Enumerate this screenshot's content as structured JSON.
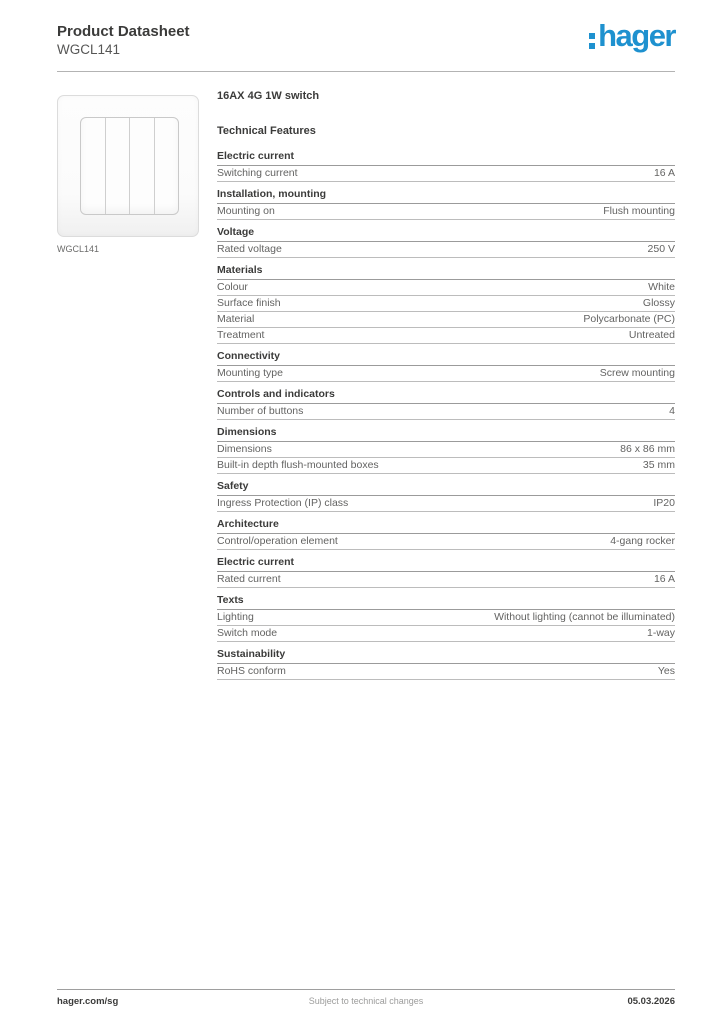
{
  "brand": {
    "logo_text": "hager",
    "brand_color": "#1e91cf"
  },
  "header": {
    "title": "Product Datasheet",
    "subtitle": "WGCL141"
  },
  "product": {
    "name": "16AX 4G 1W switch",
    "image_caption": "WGCL141",
    "rocker_gangs": 4
  },
  "technical_features_heading": "Technical Features",
  "sections": [
    {
      "heading": "Electric current",
      "rows": [
        {
          "label": "Switching current",
          "value": "16 A"
        }
      ]
    },
    {
      "heading": "Installation, mounting",
      "rows": [
        {
          "label": "Mounting on",
          "value": "Flush mounting"
        }
      ]
    },
    {
      "heading": "Voltage",
      "rows": [
        {
          "label": "Rated voltage",
          "value": "250 V"
        }
      ]
    },
    {
      "heading": "Materials",
      "rows": [
        {
          "label": "Colour",
          "value": "White"
        },
        {
          "label": "Surface finish",
          "value": "Glossy"
        },
        {
          "label": "Material",
          "value": "Polycarbonate (PC)"
        },
        {
          "label": "Treatment",
          "value": "Untreated"
        }
      ]
    },
    {
      "heading": "Connectivity",
      "rows": [
        {
          "label": "Mounting type",
          "value": "Screw mounting"
        }
      ]
    },
    {
      "heading": "Controls and indicators",
      "rows": [
        {
          "label": "Number of buttons",
          "value": "4"
        }
      ]
    },
    {
      "heading": "Dimensions",
      "rows": [
        {
          "label": "Dimensions",
          "value": "86 x 86 mm"
        },
        {
          "label": "Built-in depth flush-mounted boxes",
          "value": "35 mm"
        }
      ]
    },
    {
      "heading": "Safety",
      "rows": [
        {
          "label": "Ingress Protection (IP) class",
          "value": "IP20"
        }
      ]
    },
    {
      "heading": "Architecture",
      "rows": [
        {
          "label": "Control/operation element",
          "value": "4-gang rocker"
        }
      ]
    },
    {
      "heading": "Electric current",
      "rows": [
        {
          "label": "Rated current",
          "value": "16 A"
        }
      ]
    },
    {
      "heading": "Texts",
      "rows": [
        {
          "label": "Lighting",
          "value": "Without lighting (cannot be illuminated)"
        },
        {
          "label": "Switch mode",
          "value": "1-way"
        }
      ]
    },
    {
      "heading": "Sustainability",
      "rows": [
        {
          "label": "RoHS conform",
          "value": "Yes"
        }
      ]
    }
  ],
  "footer": {
    "left": "hager.com/sg",
    "center": "Subject to technical changes",
    "right": "05.03.2026"
  }
}
